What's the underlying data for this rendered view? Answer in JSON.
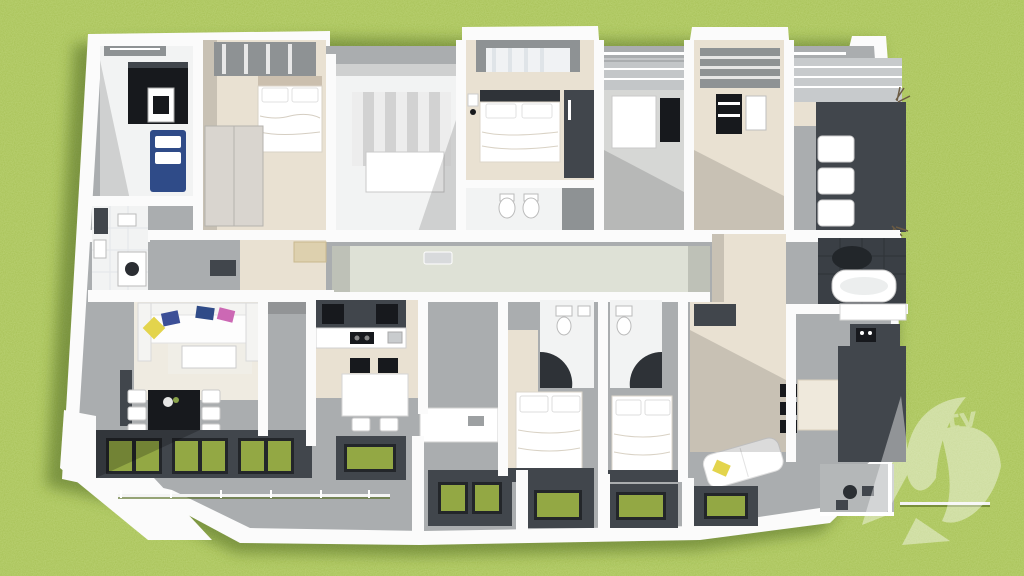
{
  "scene": {
    "type": "3d-architectural-floor-plan-render",
    "view": "aerial-perspective-cutaway",
    "setting": "green-lawn",
    "rooms": [
      "bedroom-1",
      "bedroom-2",
      "stairwell",
      "bedroom-3",
      "utility-room",
      "bedroom-4",
      "walk-in-closet",
      "bathroom-left",
      "corridor",
      "bathroom-right",
      "living-room-left",
      "dining-area-left",
      "kitchen-left",
      "bathroom-center-1",
      "bathroom-center-2",
      "bedroom-5",
      "bedroom-6",
      "living-area-right",
      "dining-area-right",
      "kitchen-right",
      "terrace-left",
      "window-bays",
      "balcony-right"
    ]
  },
  "colors": {
    "grass-base": "#7da32f",
    "grass-shadow": "#46601a",
    "wall": "#fbfbfb",
    "wall-shade": "#d2d4d6",
    "floor-gray": "#aaadaf",
    "floor-gray-dark": "#8e9294",
    "charcoal": "#41464c",
    "near-black": "#17191d",
    "wood": "#e9e1d2",
    "wood-light": "#efebe1",
    "tile": "#f2f3f3",
    "corridor": "#dee1d6",
    "glass-green": "#93a844",
    "glass-frame": "#23262a",
    "sofa-blue": "#2f4b88",
    "pillow-navy": "#3c4f97",
    "pillow-yellow": "#e3d44c",
    "pillow-pink": "#cc68b4",
    "cabinet-beige": "#ddd0ae",
    "shadow": "#000000",
    "watermark": "#ffffff"
  },
  "watermark": {
    "text": "tv",
    "opacity": 0.42
  }
}
